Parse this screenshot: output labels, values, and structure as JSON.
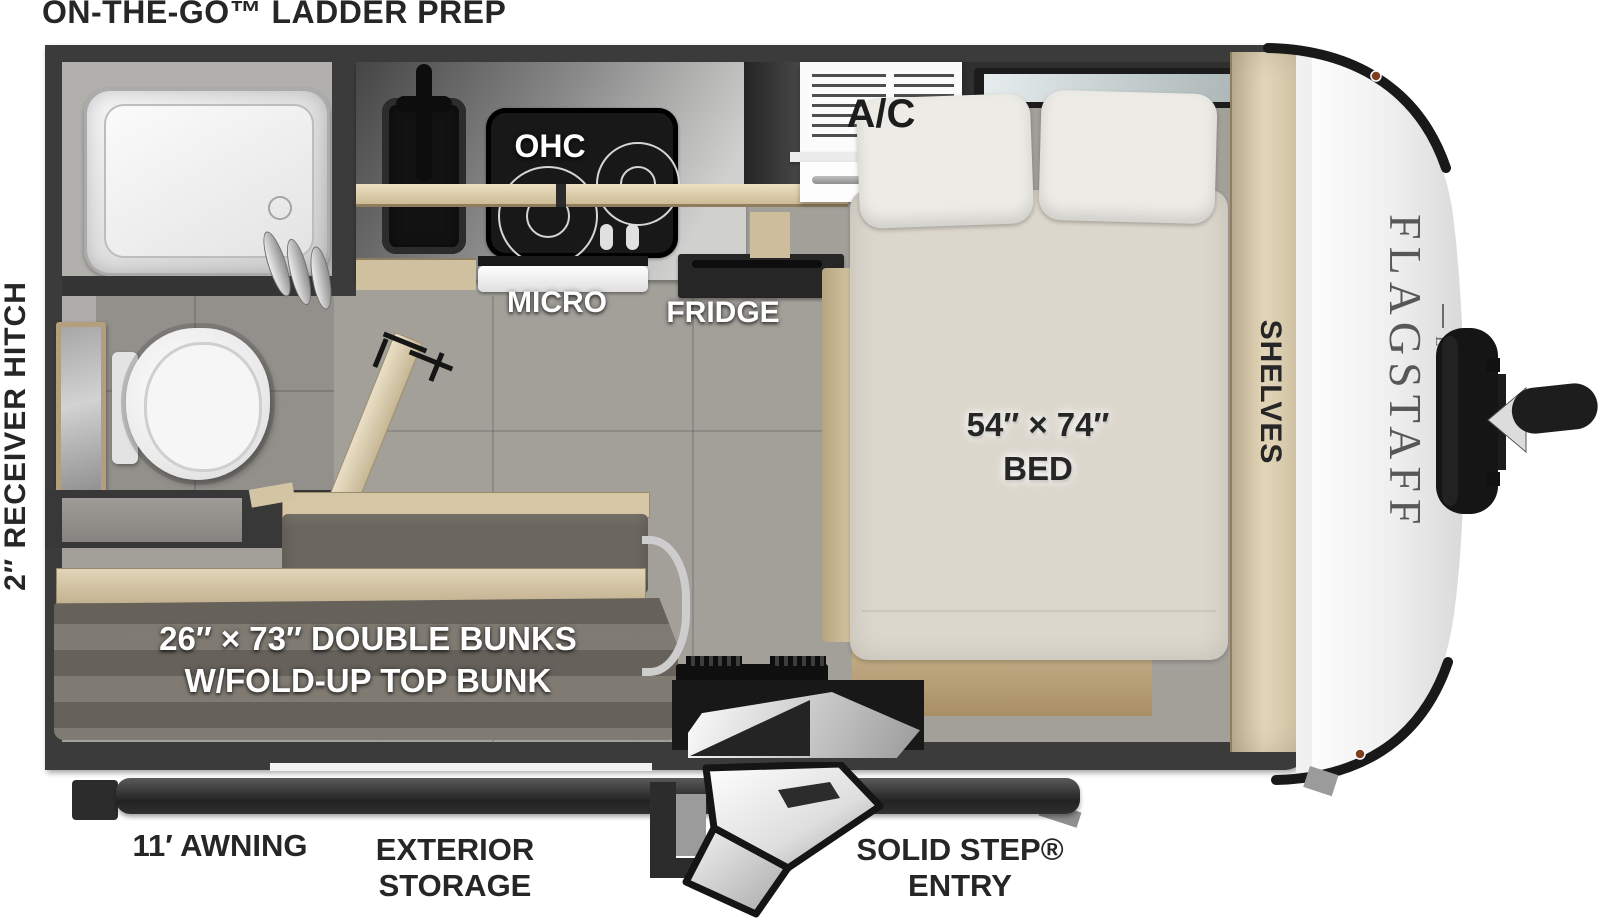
{
  "header": {
    "prep_label": "ON-THE-GO™ LADDER PREP"
  },
  "left": {
    "hitch_label": "2″ RECEIVER HITCH"
  },
  "interior": {
    "ohc": "OHC",
    "ac": "A/C",
    "micro": "MICRO",
    "fridge": "FRIDGE",
    "bed_size": "54″ × 74″",
    "bed": "BED",
    "shelves": "SHELVES",
    "bunks_line1": "26″ × 73″ DOUBLE BUNKS",
    "bunks_line2": "W/FOLD-UP TOP BUNK"
  },
  "exterior": {
    "awning": "11′ AWNING",
    "storage_line1": "EXTERIOR",
    "storage_line2": "STORAGE",
    "entry_line1": "SOLID STEP®",
    "entry_line2": "ENTRY"
  },
  "branding": {
    "model": "FLAGSTAFF",
    "trim": "E-PRO"
  },
  "colors": {
    "wall": "#3b3b3b",
    "floor": "#a3a09a",
    "bath_floor": "#93908b",
    "wood": "#d6c8a8",
    "mattress": "#dcd7cd",
    "pillow": "#edebe5",
    "bunk_cushion": "#79746b",
    "appliance_black": "#151515",
    "cap_white": "#f2f2f2",
    "label_dark": "#262626",
    "label_light": "#ffffff"
  }
}
